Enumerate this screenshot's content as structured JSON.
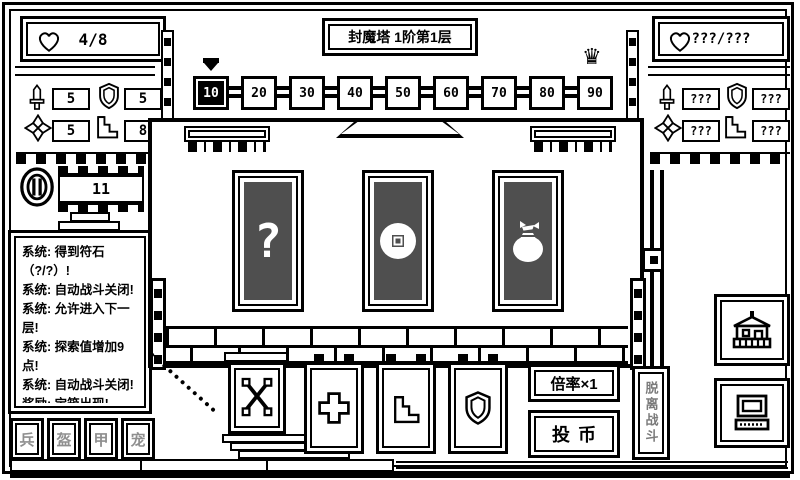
{
  "app": {
    "title": "封魔塔 1阶第1层"
  },
  "player_panel": {
    "hp": "4/8",
    "attack": "5",
    "defense": "5",
    "luck": "5",
    "agility": "8",
    "coins": "11"
  },
  "enemy_panel": {
    "hp": "???/???",
    "attack": "???",
    "defense": "???",
    "luck": "???",
    "agility": "???"
  },
  "floor_track": {
    "nodes": [
      "10",
      "20",
      "30",
      "40",
      "50",
      "60",
      "70",
      "80",
      "90"
    ],
    "current": "10"
  },
  "treasure_cards": [
    {
      "name": "mystery-card",
      "icon": "question-mark"
    },
    {
      "name": "coin-card",
      "icon": "coin"
    },
    {
      "name": "moneybag-card",
      "icon": "money-bag"
    }
  ],
  "message_log": {
    "lines": [
      "系统: 得到符石（?/?）!",
      "系统: 自动战斗关闭!",
      "系统: 允许进入下一层!",
      "系统: 探索值增加9点!",
      "系统: 自动战斗关闭!",
      "奖励: 宝箱出现!",
      "当前探索值:8/100!"
    ]
  },
  "menu_tabs": [
    {
      "label": "兵"
    },
    {
      "label": "盔"
    },
    {
      "label": "甲"
    },
    {
      "label": "宠"
    }
  ],
  "controls": {
    "multiplier_label": "倍率×1",
    "insert_coin_label": "投币",
    "leave_battle_label": "脱离战斗"
  },
  "icons": {
    "crown": "♛",
    "question_mark": "?"
  }
}
